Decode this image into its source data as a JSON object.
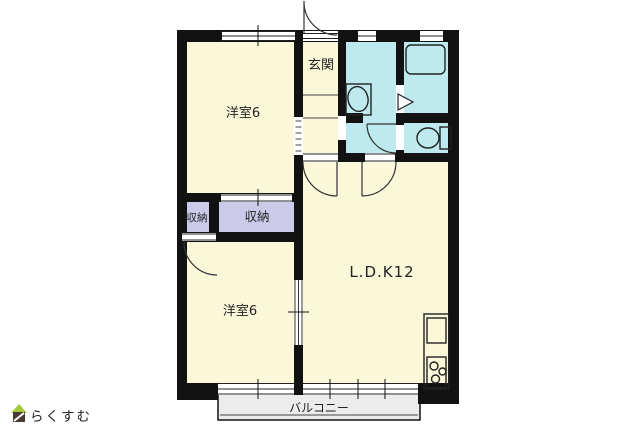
{
  "plan": {
    "rooms": {
      "bedroom_top": {
        "label": "洋室6"
      },
      "entrance": {
        "label": "玄関"
      },
      "closet_left": {
        "label": "収納"
      },
      "closet_right": {
        "label": "収納"
      },
      "bedroom_bottom": {
        "label": "洋室6"
      },
      "ldk": {
        "label": "L.D.K12"
      },
      "balcony": {
        "label": "バルコニー"
      }
    },
    "fixtures": [
      "washbasin",
      "bathtub",
      "bath-door",
      "toilet",
      "kitchen-sink",
      "stove"
    ]
  },
  "logo": {
    "text": "らくすむ"
  },
  "colors": {
    "room": "#FBF7D9",
    "wet": "#BEE9EF",
    "closet": "#CBCBE9",
    "wall": "#121212",
    "balcony": "#ECECEC",
    "logo_roof": "#A5C93C",
    "logo_body": "#4A3B30",
    "logo_text": "#8C7E70"
  }
}
